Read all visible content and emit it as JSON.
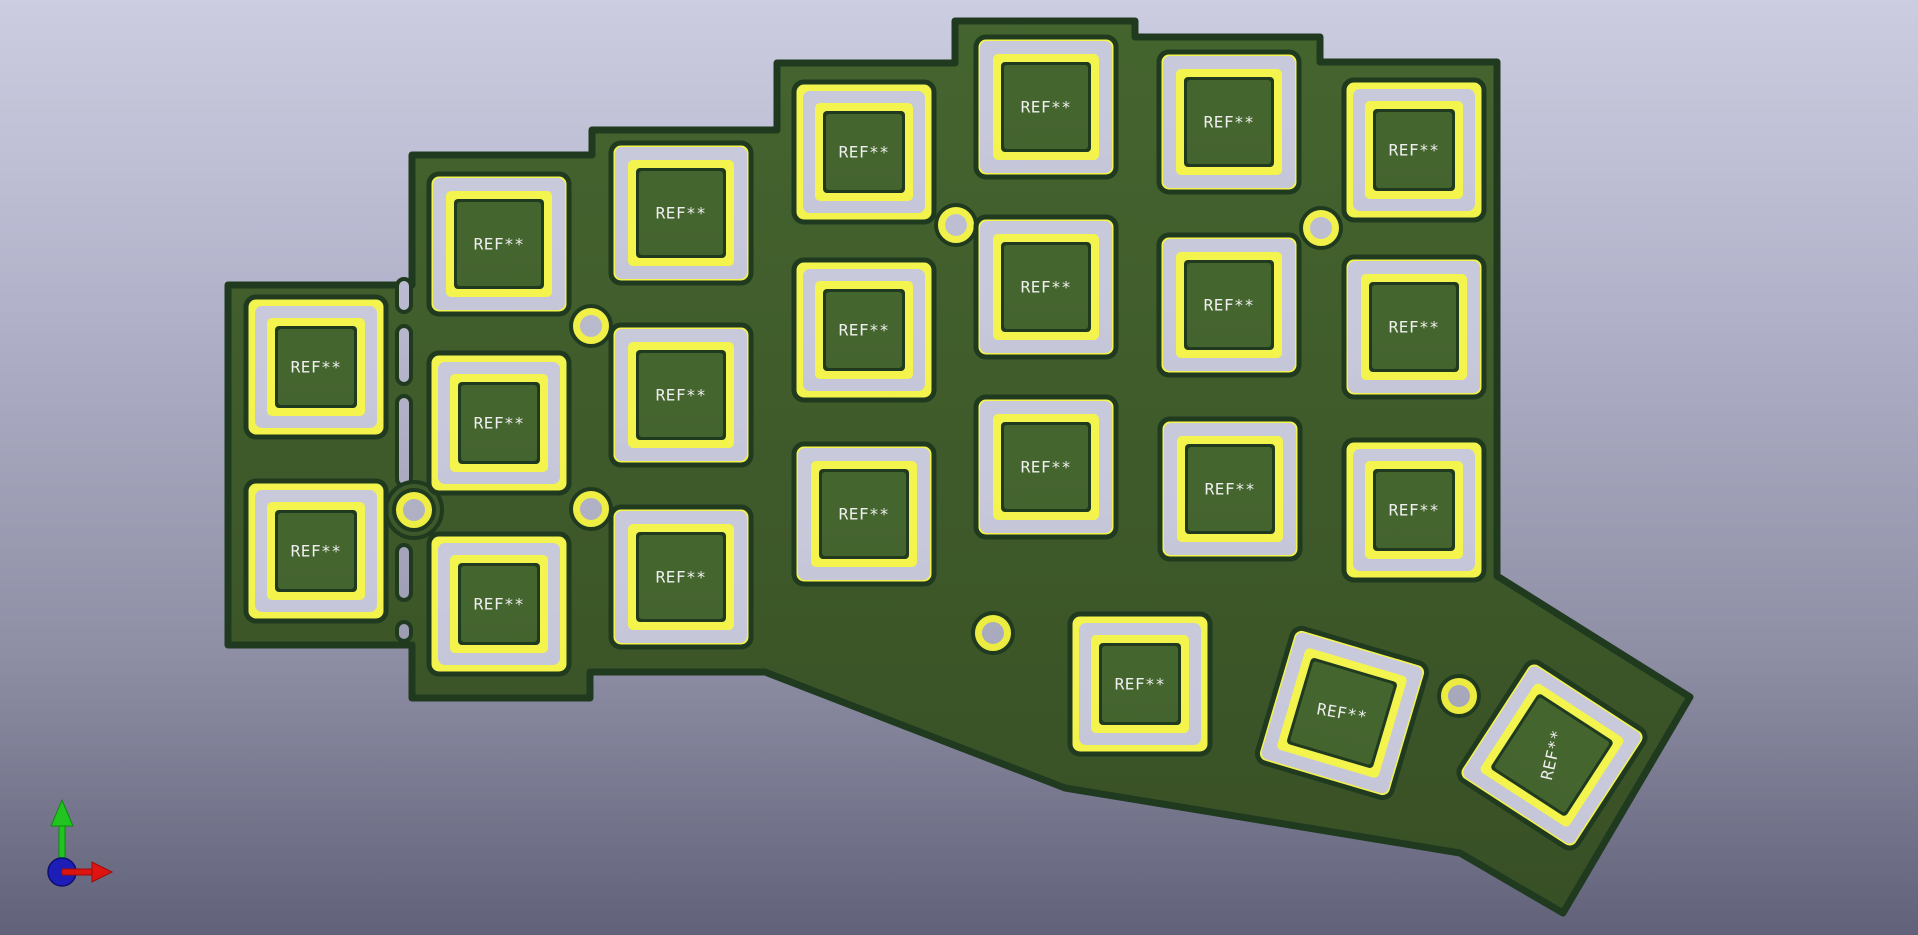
{
  "viewer": {
    "type": "pcb-3d-viewer",
    "background_top": "#cdcde1",
    "background_bottom": "#616179"
  },
  "board": {
    "outline_color": "#1f3a1f",
    "fill_top": "#45652f",
    "fill_bottom": "#384f25",
    "outline_points": [
      [
        228,
        285
      ],
      [
        412,
        285
      ],
      [
        412,
        155
      ],
      [
        592,
        155
      ],
      [
        592,
        130
      ],
      [
        777,
        130
      ],
      [
        777,
        63
      ],
      [
        955,
        63
      ],
      [
        955,
        21
      ],
      [
        1135,
        21
      ],
      [
        1135,
        37
      ],
      [
        1320,
        37
      ],
      [
        1320,
        62
      ],
      [
        1497,
        62
      ],
      [
        1497,
        576
      ],
      [
        1690,
        697
      ],
      [
        1563,
        913
      ],
      [
        1460,
        853
      ],
      [
        1065,
        788
      ],
      [
        765,
        672
      ],
      [
        590,
        672
      ],
      [
        590,
        698
      ],
      [
        412,
        698
      ],
      [
        412,
        645
      ],
      [
        228,
        645
      ]
    ],
    "slots": {
      "x": 397,
      "width": 14,
      "segments": [
        [
          279,
          312
        ],
        [
          326,
          384
        ],
        [
          396,
          486
        ],
        [
          545,
          600
        ],
        [
          622,
          641
        ]
      ],
      "fill_top": "#bcbcd3",
      "fill_bottom": "#9a9ab0"
    }
  },
  "pads": {
    "yellow_top": "#f4f44e",
    "yellow_bottom": "#e9e83a",
    "gray_top": "#c9c9dc",
    "gray_bottom": "#9c9cb1",
    "silk_text_color": "#efefef"
  },
  "footprints": {
    "ref_label": "REF**",
    "size": 140,
    "items": [
      {
        "x": 316,
        "y": 367,
        "rot": 0,
        "text_rot": 0,
        "variant": "t"
      },
      {
        "x": 316,
        "y": 551,
        "rot": 0,
        "text_rot": 0,
        "variant": "t"
      },
      {
        "x": 499,
        "y": 244,
        "rot": 0,
        "text_rot": 0,
        "variant": "n"
      },
      {
        "x": 499,
        "y": 423,
        "rot": 0,
        "text_rot": 0,
        "variant": "t"
      },
      {
        "x": 499,
        "y": 604,
        "rot": 0,
        "text_rot": 0,
        "variant": "t"
      },
      {
        "x": 681,
        "y": 213,
        "rot": 0,
        "text_rot": 0,
        "variant": "n"
      },
      {
        "x": 681,
        "y": 395,
        "rot": 0,
        "text_rot": 0,
        "variant": "n"
      },
      {
        "x": 681,
        "y": 577,
        "rot": 0,
        "text_rot": 0,
        "variant": "n"
      },
      {
        "x": 864,
        "y": 152,
        "rot": 0,
        "text_rot": 0,
        "variant": "t"
      },
      {
        "x": 864,
        "y": 330,
        "rot": 0,
        "text_rot": 0,
        "variant": "t"
      },
      {
        "x": 864,
        "y": 514,
        "rot": 0,
        "text_rot": 0,
        "variant": "n"
      },
      {
        "x": 1046,
        "y": 107,
        "rot": 0,
        "text_rot": 0,
        "variant": "n"
      },
      {
        "x": 1046,
        "y": 287,
        "rot": 0,
        "text_rot": 0,
        "variant": "n"
      },
      {
        "x": 1046,
        "y": 467,
        "rot": 0,
        "text_rot": 0,
        "variant": "n"
      },
      {
        "x": 1229,
        "y": 122,
        "rot": 0,
        "text_rot": 0,
        "variant": "n"
      },
      {
        "x": 1229,
        "y": 305,
        "rot": 0,
        "text_rot": 0,
        "variant": "n"
      },
      {
        "x": 1230,
        "y": 489,
        "rot": 0,
        "text_rot": 0,
        "variant": "n"
      },
      {
        "x": 1414,
        "y": 150,
        "rot": 0,
        "text_rot": 0,
        "variant": "t"
      },
      {
        "x": 1414,
        "y": 327,
        "rot": 0,
        "text_rot": 0,
        "variant": "n"
      },
      {
        "x": 1414,
        "y": 510,
        "rot": 0,
        "text_rot": 0,
        "variant": "t"
      },
      {
        "x": 1140,
        "y": 684,
        "rot": 0,
        "text_rot": 0,
        "variant": "t"
      },
      {
        "x": 1342,
        "y": 713,
        "rot": 16.5,
        "text_rot": 10,
        "variant": "n"
      },
      {
        "x": 1552,
        "y": 755,
        "rot": 33,
        "text_rot": -77,
        "variant": "n"
      }
    ],
    "variants": {
      "t": {
        "outer_yellow": 9,
        "gray": 12,
        "inner_yellow": 8,
        "dark_gap": 3
      },
      "n": {
        "outer_yellow": 4,
        "gray": 13,
        "inner_yellow": 8,
        "dark_gap": 3
      }
    }
  },
  "holes": {
    "ring_radius": 20,
    "bore_radius": 11,
    "items": [
      {
        "x": 414,
        "y": 510,
        "bridge": true
      },
      {
        "x": 591,
        "y": 326,
        "bridge": false
      },
      {
        "x": 591,
        "y": 509,
        "bridge": false
      },
      {
        "x": 956,
        "y": 225,
        "bridge": false
      },
      {
        "x": 993,
        "y": 633,
        "bridge": false
      },
      {
        "x": 1321,
        "y": 228,
        "bridge": false
      },
      {
        "x": 1459,
        "y": 696,
        "bridge": false
      }
    ]
  },
  "axis_gizmo": {
    "x": 62,
    "y": 872,
    "sphere_radius": 14,
    "y_axis_color": "#21c421",
    "y_axis_dark": "#0d8a0d",
    "x_axis_color": "#dd1410",
    "x_axis_dark": "#9e0c08",
    "z_axis_color": "#1d1db8",
    "z_axis_dark": "#0d0d70"
  }
}
